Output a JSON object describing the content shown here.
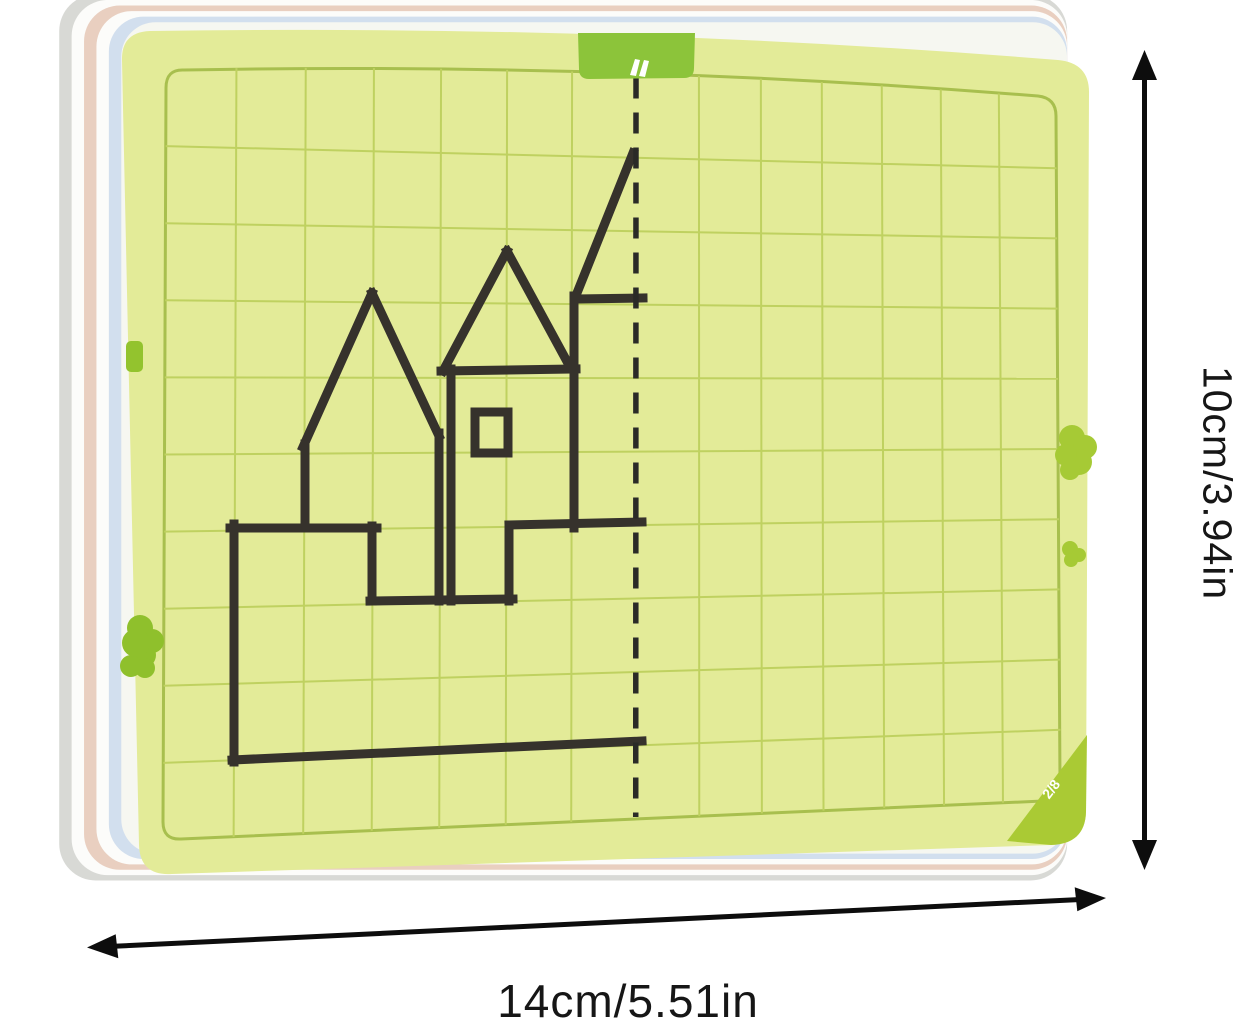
{
  "product": {
    "name": "mirror-symmetry drawing card with castle outline",
    "corner_label": "2/8",
    "grid": {
      "cols": 14,
      "rows": 10
    },
    "colors": {
      "card_fill": "#e3eb98",
      "grid_line": "#bfd160",
      "grid_border": "#a8bf4e",
      "accent_green": "#8cc43a",
      "corner_triangle": "#aaca34",
      "clip_green": "#97c530",
      "outline_ink": "#36322c",
      "axis_ink": "#2a2a27",
      "arrow_ink": "#0d0d0d"
    },
    "stack_layer_colors": [
      "#d8d9d5",
      "#fcfcfa",
      "#e9cfc0",
      "#fcfcfa",
      "#d2dfee",
      "#f6f7f1"
    ]
  },
  "castle_outline": {
    "segments": [
      [
        372,
        293,
        303,
        447
      ],
      [
        305,
        444,
        305,
        528
      ],
      [
        372,
        293,
        439,
        436
      ],
      [
        439,
        433,
        439,
        601
      ],
      [
        451,
        369,
        451,
        601
      ],
      [
        507,
        251,
        443,
        371
      ],
      [
        507,
        251,
        570,
        367
      ],
      [
        441,
        371,
        576,
        369
      ],
      [
        633,
        153,
        577,
        293
      ],
      [
        575,
        299,
        643,
        298
      ],
      [
        574,
        296,
        574,
        528
      ],
      [
        509,
        525,
        642,
        522
      ],
      [
        509,
        525,
        509,
        601
      ],
      [
        370,
        601,
        513,
        599
      ],
      [
        372,
        526,
        372,
        601
      ],
      [
        230,
        528,
        377,
        528
      ],
      [
        234,
        524,
        234,
        762
      ],
      [
        232,
        760,
        642,
        741
      ]
    ],
    "window": {
      "x": 475,
      "y": 412,
      "w": 33,
      "h": 41
    }
  },
  "dimensions": {
    "height_label": "10cm/3.94in",
    "width_label": "14cm/5.51in"
  }
}
